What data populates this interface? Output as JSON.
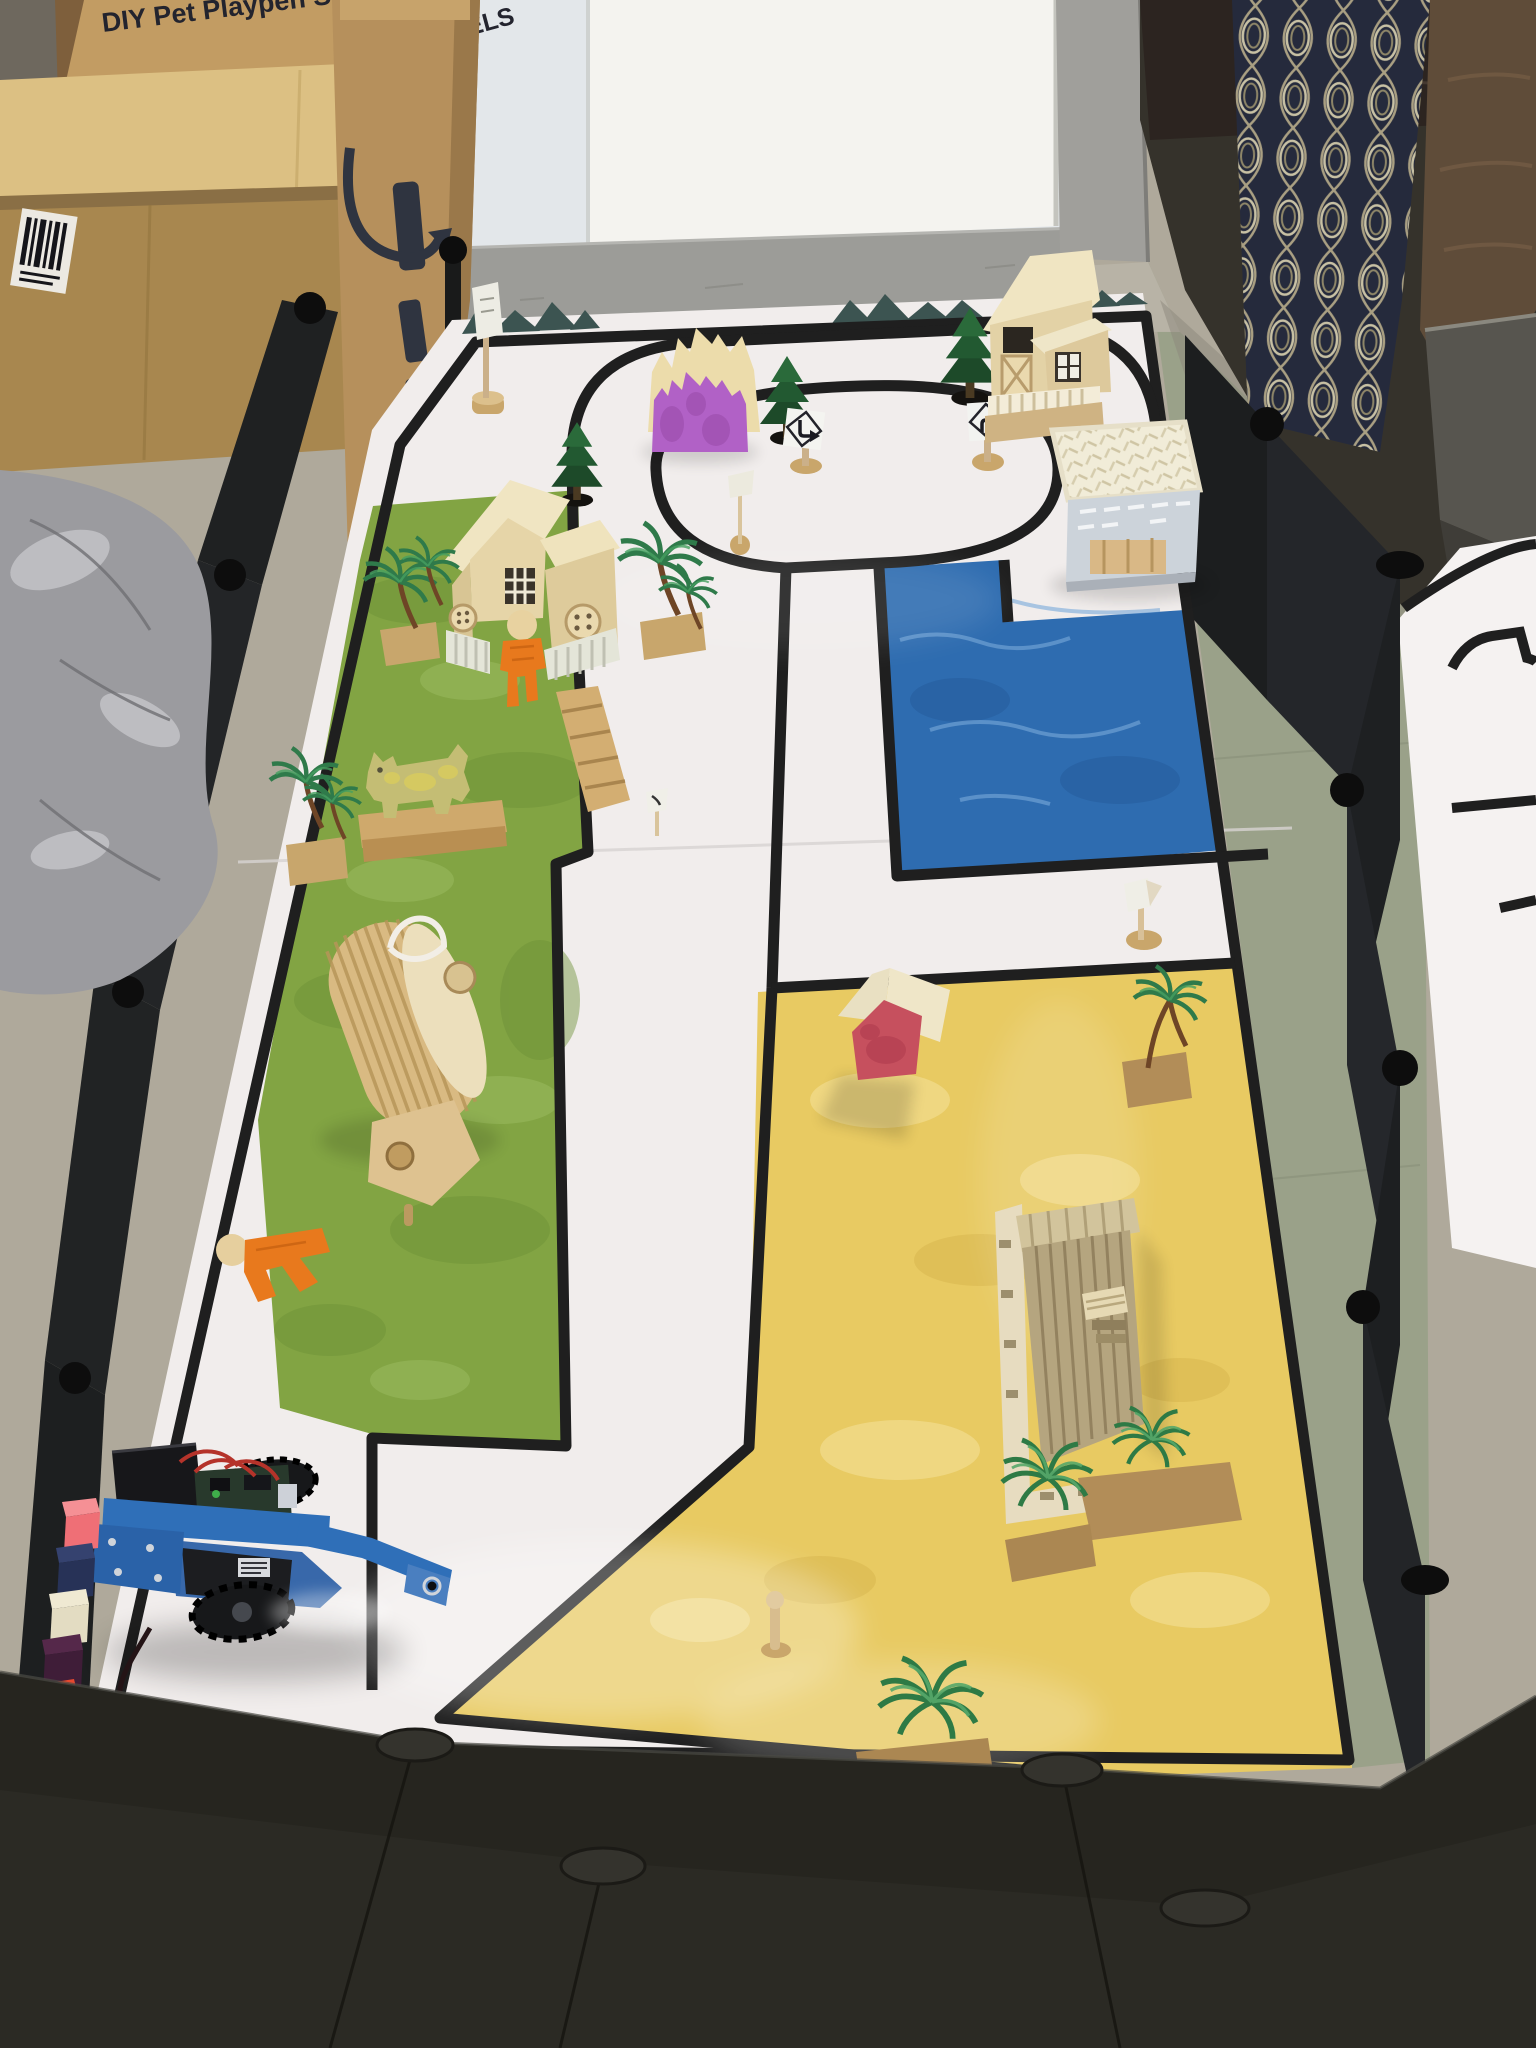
{
  "scene": {
    "kind": "photo",
    "subject": "robot-car on a toy-town play mat arena enclosed by a DIY pet playpen fence"
  },
  "box": {
    "line1": "DIY Pet Playpen Set",
    "line2": "24 PANELS"
  },
  "objects": [
    "robot-car",
    "play-mat",
    "grass-zone",
    "water-zone",
    "sand-zone",
    "castle-cutout",
    "garden-house",
    "village-house",
    "lattice-crate",
    "red-hut",
    "plank-tower",
    "dog-cutout",
    "barrel-roller",
    "orange-figure-standing",
    "orange-figure-lying",
    "pine-trees",
    "palm-trees",
    "road-signs",
    "colored-blocks",
    "playpen-fence",
    "cardboard-boxes",
    "silver-bag",
    "patterned-cushion",
    "second-track-mat"
  ],
  "colors": {
    "floor": "#afa99b",
    "floor_right": "#9aa189",
    "wall": "#e3e7ea",
    "wall_board": "#f4f3ef",
    "baseboard": "#9c9c98",
    "pillar": "#a09f9b",
    "cardboard": "#c29c63",
    "cardboard_light": "#dcc083",
    "cardboard_dark": "#a8874f",
    "amazon_box": "#b6905c",
    "logo_navy": "#2f3440",
    "bag": "#9b9b9f",
    "fence": "#26251f",
    "fence_panel": "#222427",
    "connector": "#0d0d0d",
    "mat": "#f1edec",
    "mat2": "#f5f2f1",
    "road": "#1f1f1f",
    "grass": "#82a443",
    "water": "#2e6cb0",
    "sand": "#e8ca62",
    "mountain": "#3c5451",
    "castle_purple": "#b161c6",
    "castle_wood": "#ecdcab",
    "house_cream": "#f0e5c2",
    "house_tan": "#e3d2a6",
    "wood": "#c9a66b",
    "pine": "#1d4a29",
    "palm": "#2f7a4a",
    "trunk": "#6e4526",
    "robot_blue": "#2f6fb8",
    "robot_dark": "#17181a",
    "hut_red": "#c6505e",
    "figure_orange": "#e8791d",
    "cushion": "#252a3c",
    "cushion_line": "#c8c1a4",
    "leather": "#5f4c39",
    "chair": "#57554f"
  }
}
